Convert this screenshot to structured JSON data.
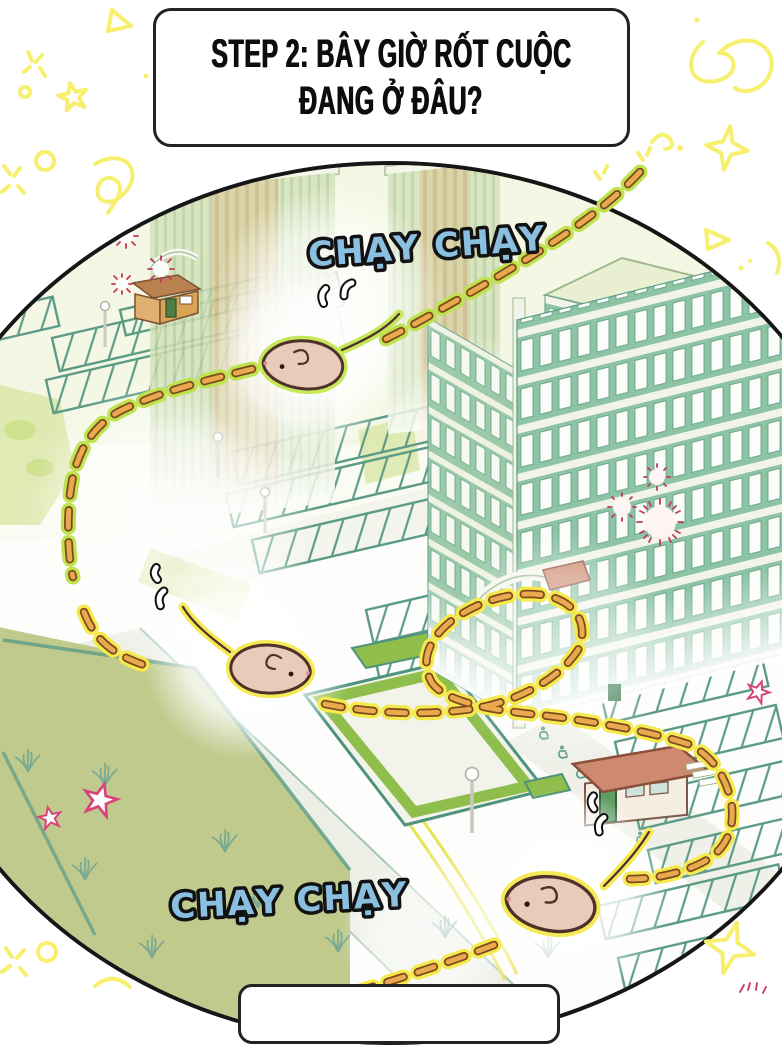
{
  "title_box": {
    "line1": "STEP 2: BÂY GIỜ RỐT CUỘC",
    "line2": "ĐANG Ở ĐÂU?"
  },
  "sfx": {
    "top": "CHẠY CHẠY",
    "bottom": "CHẠY CHẠY"
  },
  "colors": {
    "outline": "#161616",
    "sfx-fill": "#8abfdf",
    "trail-dash": "#e9a94e",
    "trail-dash-border": "#7c4a1e",
    "trail-glow-lime": "#bfe24f",
    "trail-glow-yellow": "#f5e94e",
    "mouse-body": "#e8cbb9",
    "mouse-outline": "#4f312b",
    "doodle-yellow": "#f7ef6e",
    "star-pink": "#d9437a",
    "building-green": "#8cc4a4",
    "building-teal": "#5b9b87",
    "lawn-olive": "#bfca8c",
    "lawn-bright": "#8fbe4d",
    "roof-salmon": "#cd8a70",
    "guard-tan": "#d8a355",
    "sparkle-crimson": "#c2375f"
  }
}
